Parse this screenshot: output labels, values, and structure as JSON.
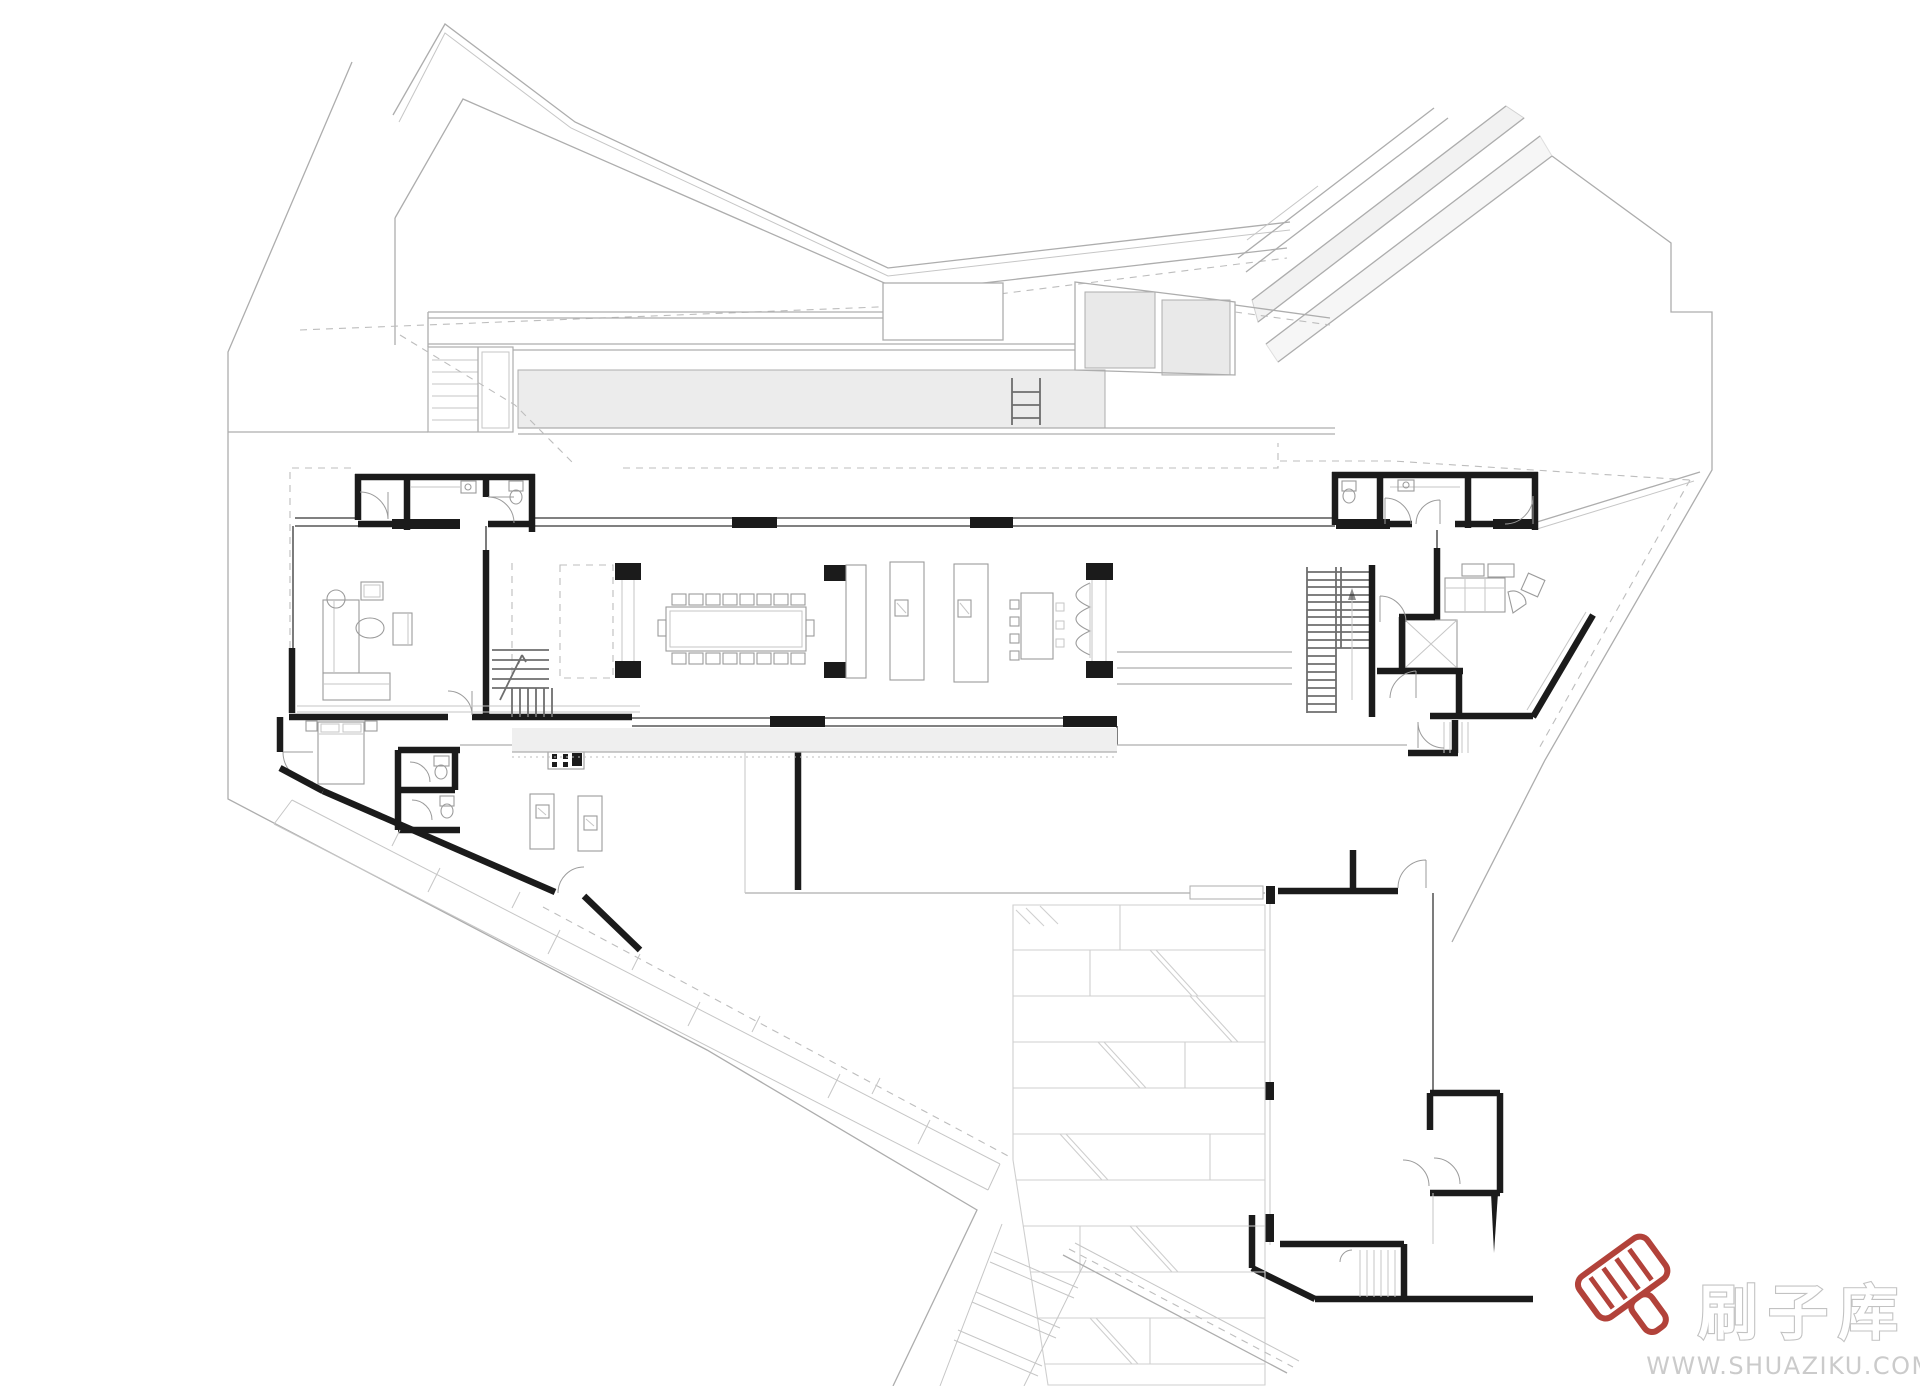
{
  "page": {
    "background": "#ffffff",
    "width": 1920,
    "height": 1386,
    "content_type": "architectural floor plan line drawing, no text labels"
  },
  "palette": {
    "wall": "#1b1b1b",
    "line_mid": "#6e6e6e",
    "line_light": "#adadad",
    "line_faint": "#c6c6c6",
    "dash": "#bdbdbd",
    "brick_line": "#cfcfcf",
    "fill_pool": "#ececec",
    "fill_panel": "#e9e9e9",
    "fill_deck": "#efefef",
    "furn_line": "#9b9b9b",
    "brush_red": "#b2423a",
    "brand_fill": "#ffffff",
    "brand_outline": "#c2c2c2",
    "url_color": "#cbcbcb"
  },
  "watermark": {
    "brand_text": "刷子库",
    "site_url": "WWW.SHUAZIKU.COM"
  }
}
